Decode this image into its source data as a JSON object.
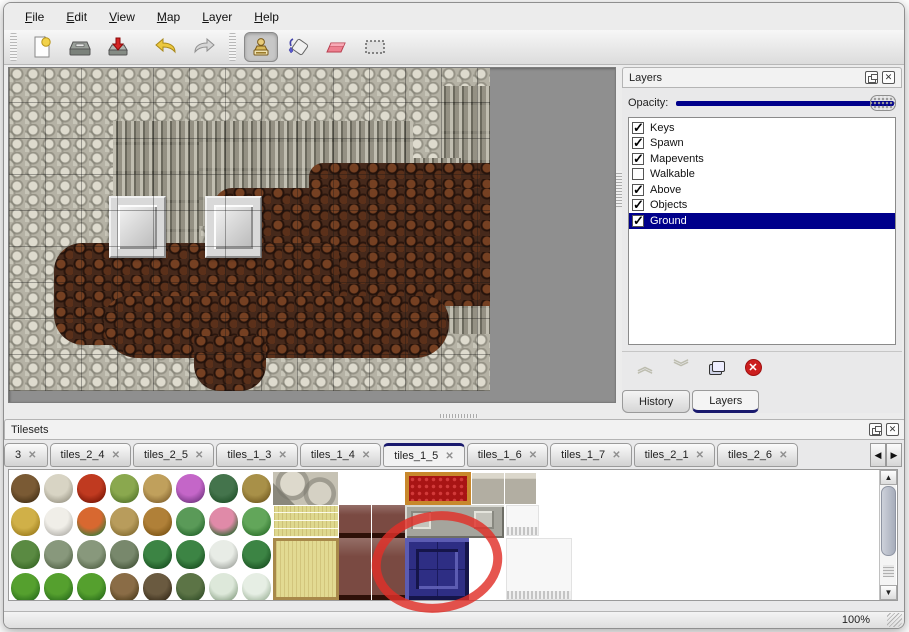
{
  "icons": {
    "close_glyph": "✕",
    "up_glyph": "▲",
    "down_glyph": "▼",
    "left_glyph": "◀",
    "right_glyph": "▶",
    "chev_up": "︽",
    "chev_down": "︾",
    "check_glyph": "✓"
  },
  "colors": {
    "accent_navy": "#00008b",
    "annotation_red": "#e03028",
    "selection_text": "#ffffff",
    "canvas_gray": "#8f8f8f"
  },
  "menu": {
    "items": [
      {
        "label": "File"
      },
      {
        "label": "Edit"
      },
      {
        "label": "View"
      },
      {
        "label": "Map"
      },
      {
        "label": "Layer"
      },
      {
        "label": "Help"
      }
    ]
  },
  "toolbar": {
    "buttons": [
      {
        "name": "new-map-icon"
      },
      {
        "name": "open-icon"
      },
      {
        "name": "save-export-icon"
      },
      {
        "name": "undo-icon"
      },
      {
        "name": "redo-icon"
      },
      {
        "name": "stamp-tool-icon",
        "selected": true
      },
      {
        "name": "fill-tool-icon"
      },
      {
        "name": "eraser-tool-icon"
      },
      {
        "name": "select-tool-icon"
      }
    ]
  },
  "layers_panel": {
    "title": "Layers",
    "opacity_label": "Opacity:",
    "opacity_percent": 100,
    "layers": [
      {
        "name": "Keys",
        "checked": true,
        "selected": false
      },
      {
        "name": "Spawn",
        "checked": true,
        "selected": false
      },
      {
        "name": "Mapevents",
        "checked": true,
        "selected": false
      },
      {
        "name": "Walkable",
        "checked": false,
        "selected": false
      },
      {
        "name": "Above",
        "checked": true,
        "selected": false
      },
      {
        "name": "Objects",
        "checked": true,
        "selected": false
      },
      {
        "name": "Ground",
        "checked": true,
        "selected": true
      }
    ],
    "actions": [
      {
        "name": "move-layer-up-icon",
        "enabled": false
      },
      {
        "name": "move-layer-down-icon",
        "enabled": false
      },
      {
        "name": "duplicate-layer-icon",
        "enabled": true
      },
      {
        "name": "delete-layer-icon",
        "enabled": true
      }
    ],
    "tabs": [
      {
        "label": "History",
        "active": false
      },
      {
        "label": "Layers",
        "active": true
      }
    ]
  },
  "tilesets_panel": {
    "title": "Tilesets",
    "tabs": [
      {
        "label": "3",
        "active": false
      },
      {
        "label": "tiles_2_4",
        "active": false
      },
      {
        "label": "tiles_2_5",
        "active": false
      },
      {
        "label": "tiles_1_3",
        "active": false
      },
      {
        "label": "tiles_1_4",
        "active": false
      },
      {
        "label": "tiles_1_5",
        "active": true
      },
      {
        "label": "tiles_1_6",
        "active": false
      },
      {
        "label": "tiles_1_7",
        "active": false
      },
      {
        "label": "tiles_2_1",
        "active": false
      },
      {
        "label": "tiles_2_6",
        "active": false
      }
    ],
    "nature_tiles": [
      {
        "name": "dead-tree",
        "c1": "#7a5a34",
        "c2": "#4a3418"
      },
      {
        "name": "white-branch",
        "c1": "#d8d4c4",
        "c2": "#a09c8c"
      },
      {
        "name": "red-flower",
        "c1": "#c03a20",
        "c2": "#801a08"
      },
      {
        "name": "green-stump",
        "c1": "#8aa84e",
        "c2": "#5a7a2e"
      },
      {
        "name": "tan-trunk",
        "c1": "#c0a05c",
        "c2": "#8a6a34"
      },
      {
        "name": "purple-bush",
        "c1": "#c466c8",
        "c2": "#7a3a88"
      },
      {
        "name": "fern",
        "c1": "#44744c",
        "c2": "#24542c"
      },
      {
        "name": "dry-plant",
        "c1": "#a89048",
        "c2": "#786024"
      },
      {
        "name": "hay-mound",
        "c1": "#d0b048",
        "c2": "#a08020"
      },
      {
        "name": "snow-mound",
        "c1": "#f0eee8",
        "c2": "#b8b6b0"
      },
      {
        "name": "orange-flowers",
        "c1": "#d86830",
        "c2": "#4a7a3a"
      },
      {
        "name": "dry-tuft",
        "c1": "#b89c5c",
        "c2": "#887034"
      },
      {
        "name": "scattered-leaves",
        "c1": "#b08038",
        "c2": "#805818"
      },
      {
        "name": "lily-pad",
        "c1": "#5a9a58",
        "c2": "#2a6a30"
      },
      {
        "name": "pink-flowers",
        "c1": "#e08aa8",
        "c2": "#3a6a3a"
      },
      {
        "name": "lily-pad-cut",
        "c1": "#62a65a",
        "c2": "#327630"
      },
      {
        "name": "sprouts",
        "c1": "#5a8a42",
        "c2": "#3a6a26"
      },
      {
        "name": "gray-bush",
        "c1": "#88987c",
        "c2": "#58684c"
      },
      {
        "name": "gray-bush",
        "c1": "#88987c",
        "c2": "#58684c"
      },
      {
        "name": "gray-bush",
        "c1": "#78886c",
        "c2": "#48583c"
      },
      {
        "name": "palm-tree",
        "c1": "#3c8444",
        "c2": "#1c5424"
      },
      {
        "name": "palm-tree",
        "c1": "#3c8444",
        "c2": "#1c5424"
      },
      {
        "name": "snowy-tree",
        "c1": "#e8ece6",
        "c2": "#a8aca6"
      },
      {
        "name": "palm-tree",
        "c1": "#3c8444",
        "c2": "#1c5424"
      },
      {
        "name": "conifer",
        "c1": "#55a02e",
        "c2": "#2c701c"
      },
      {
        "name": "conifer",
        "c1": "#55a02e",
        "c2": "#2c701c"
      },
      {
        "name": "conifer",
        "c1": "#55a02e",
        "c2": "#2c701c"
      },
      {
        "name": "twisted-tree",
        "c1": "#8a6c46",
        "c2": "#52401e"
      },
      {
        "name": "dark-tree",
        "c1": "#6a5a40",
        "c2": "#3a2e1c"
      },
      {
        "name": "mossy-tree",
        "c1": "#5c7446",
        "c2": "#34502a"
      },
      {
        "name": "snow-conifer",
        "c1": "#dde8da",
        "c2": "#92a88e"
      },
      {
        "name": "snow-conifer",
        "c1": "#e6eee4",
        "c2": "#a6baa2"
      }
    ],
    "blocks": [
      {
        "name": "stone-cobble-tile",
        "cls": "cobble",
        "x": 264,
        "y": 2,
        "w": 66,
        "h": 33
      },
      {
        "name": "tatami-tile",
        "cls": "tatami1",
        "x": 264,
        "y": 35,
        "w": 66,
        "h": 33
      },
      {
        "name": "tatami-border-tile",
        "cls": "tatami2",
        "x": 264,
        "y": 68,
        "w": 66,
        "h": 62
      },
      {
        "name": "table-top-tile",
        "cls": "goldtop",
        "x": 330,
        "y": 2,
        "w": 66,
        "h": 33
      },
      {
        "name": "table-maroon-tile",
        "cls": "maroon",
        "x": 330,
        "y": 35,
        "w": 66,
        "h": 33
      },
      {
        "name": "table-maroon-tile",
        "cls": "maroon",
        "x": 330,
        "y": 68,
        "w": 66,
        "h": 62
      },
      {
        "name": "red-carpet-tile",
        "cls": "carpet",
        "x": 396,
        "y": 2,
        "w": 66,
        "h": 33
      },
      {
        "name": "gray-stone-tile",
        "cls": "graytiles",
        "x": 462,
        "y": 2,
        "w": 66,
        "h": 33
      },
      {
        "name": "metal-bracket-tile",
        "cls": "metal",
        "x": 396,
        "y": 35,
        "w": 99,
        "h": 33
      },
      {
        "name": "white-curtain-tile",
        "cls": "whitesmall",
        "x": 497,
        "y": 35,
        "w": 33,
        "h": 31
      },
      {
        "name": "blue-selected-tile",
        "cls": "bluetile",
        "x": 396,
        "y": 68,
        "w": 64,
        "h": 62
      },
      {
        "name": "white-curtain-tile",
        "cls": "whitetall",
        "x": 497,
        "y": 68,
        "w": 66,
        "h": 62
      }
    ]
  },
  "statusbar": {
    "zoom": "100%"
  }
}
